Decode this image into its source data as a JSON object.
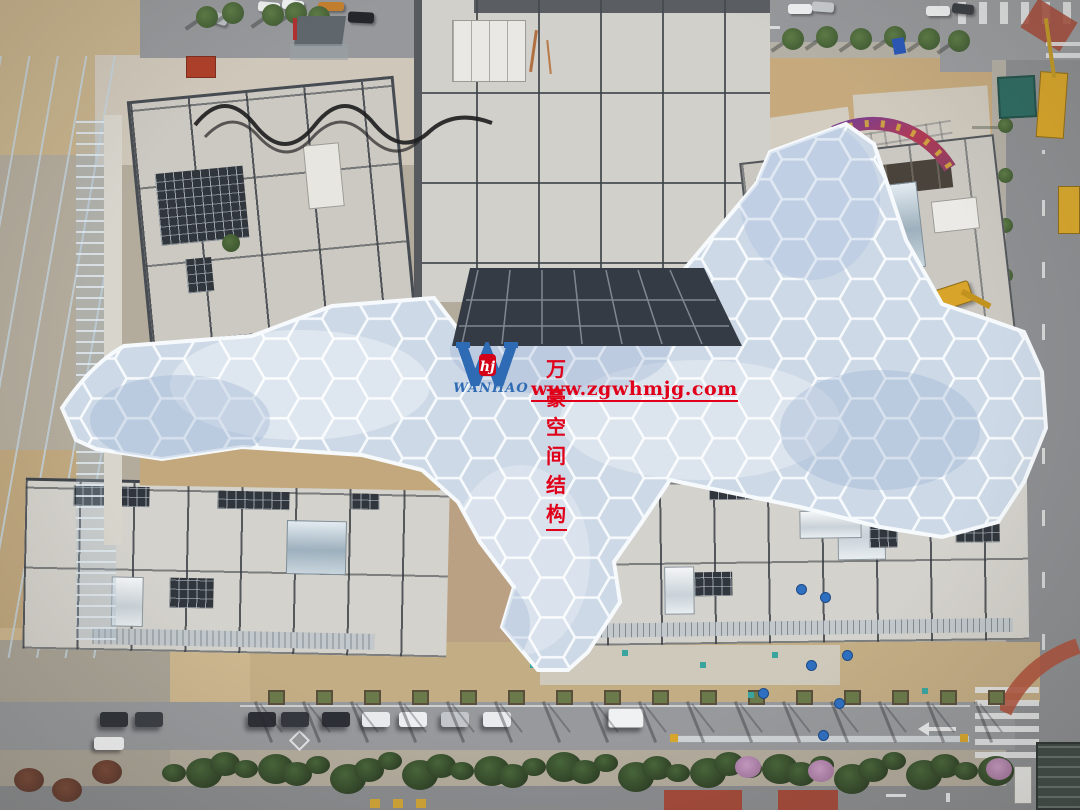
{
  "watermark": {
    "company_name": "万豪空间结构",
    "website": "www.zgwhmjg.com",
    "brand_latin": "WANHAO",
    "logo_monogram_letter": "W",
    "logo_seal_letters": "hj",
    "accent_red": "#e1001a",
    "brand_blue": "#2e6bb4"
  },
  "scene_palette": {
    "canopy_cell": "#cdd9e7",
    "canopy_frame": "#f7fafc",
    "concrete_roof": "#d2d0ca",
    "roof_seam": "#3c4147",
    "bare_soil": "#c4a97e",
    "asphalt": "#939598",
    "foliage": "#49653a",
    "machinery_yellow": "#d9a42a",
    "glass_facade": "#4e5a64"
  }
}
